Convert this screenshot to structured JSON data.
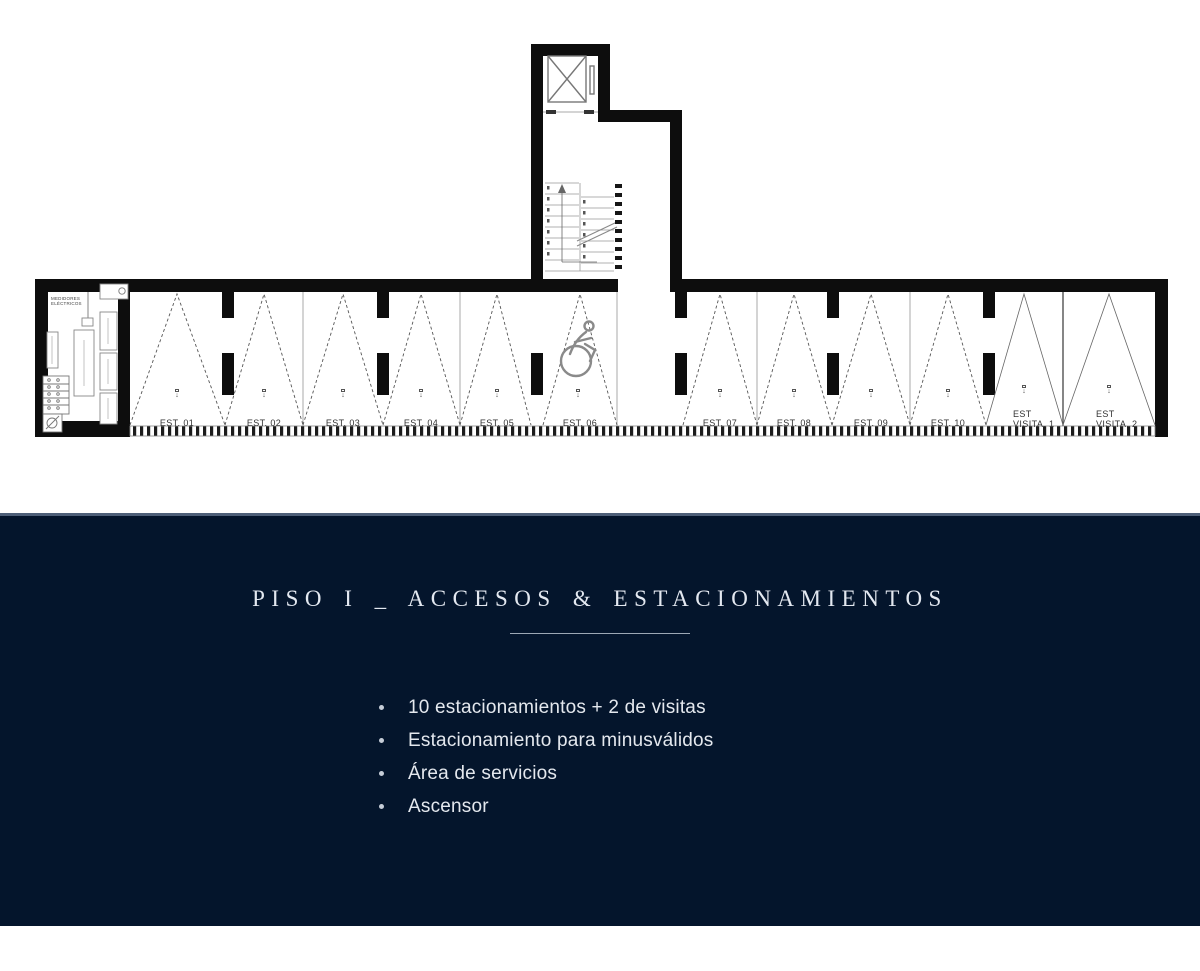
{
  "page": {
    "background": "#ffffff"
  },
  "colors": {
    "panel_navy": "#04152c",
    "panel_top_border": "#4e5f78",
    "panel_text": "#e4e8ee",
    "wall_black": "#0d0d0d",
    "thin_line_gray": "#999999"
  },
  "plan": {
    "service_area": {
      "meters_label": "MEDIDORES\nELÉCTRICOS"
    },
    "stall_marker": "↓",
    "icons": [
      "elevator-shaft-x-icon",
      "wheelchair-accessible-icon",
      "stairs-up-arrow-icon",
      "no-entry-icon"
    ],
    "stalls": [
      {
        "label": "EST. 01"
      },
      {
        "label": "EST. 02"
      },
      {
        "label": "EST. 03"
      },
      {
        "label": "EST. 04"
      },
      {
        "label": "EST. 05"
      },
      {
        "label": "EST. 06"
      },
      {
        "label": "EST. 07"
      },
      {
        "label": "EST. 08"
      },
      {
        "label": "EST. 09"
      },
      {
        "label": "EST. 10"
      },
      {
        "label": "EST\nVISITA. 1"
      },
      {
        "label": "EST\nVISITA. 2"
      }
    ],
    "accessible_stall": "EST. 06"
  },
  "panel": {
    "title": "PISO I _ ACCESOS & ESTACIONAMIENTOS",
    "bullets": [
      "10 estacionamientos + 2 de visitas",
      "Estacionamiento para minusválidos",
      "Área de servicios",
      "Ascensor"
    ]
  }
}
